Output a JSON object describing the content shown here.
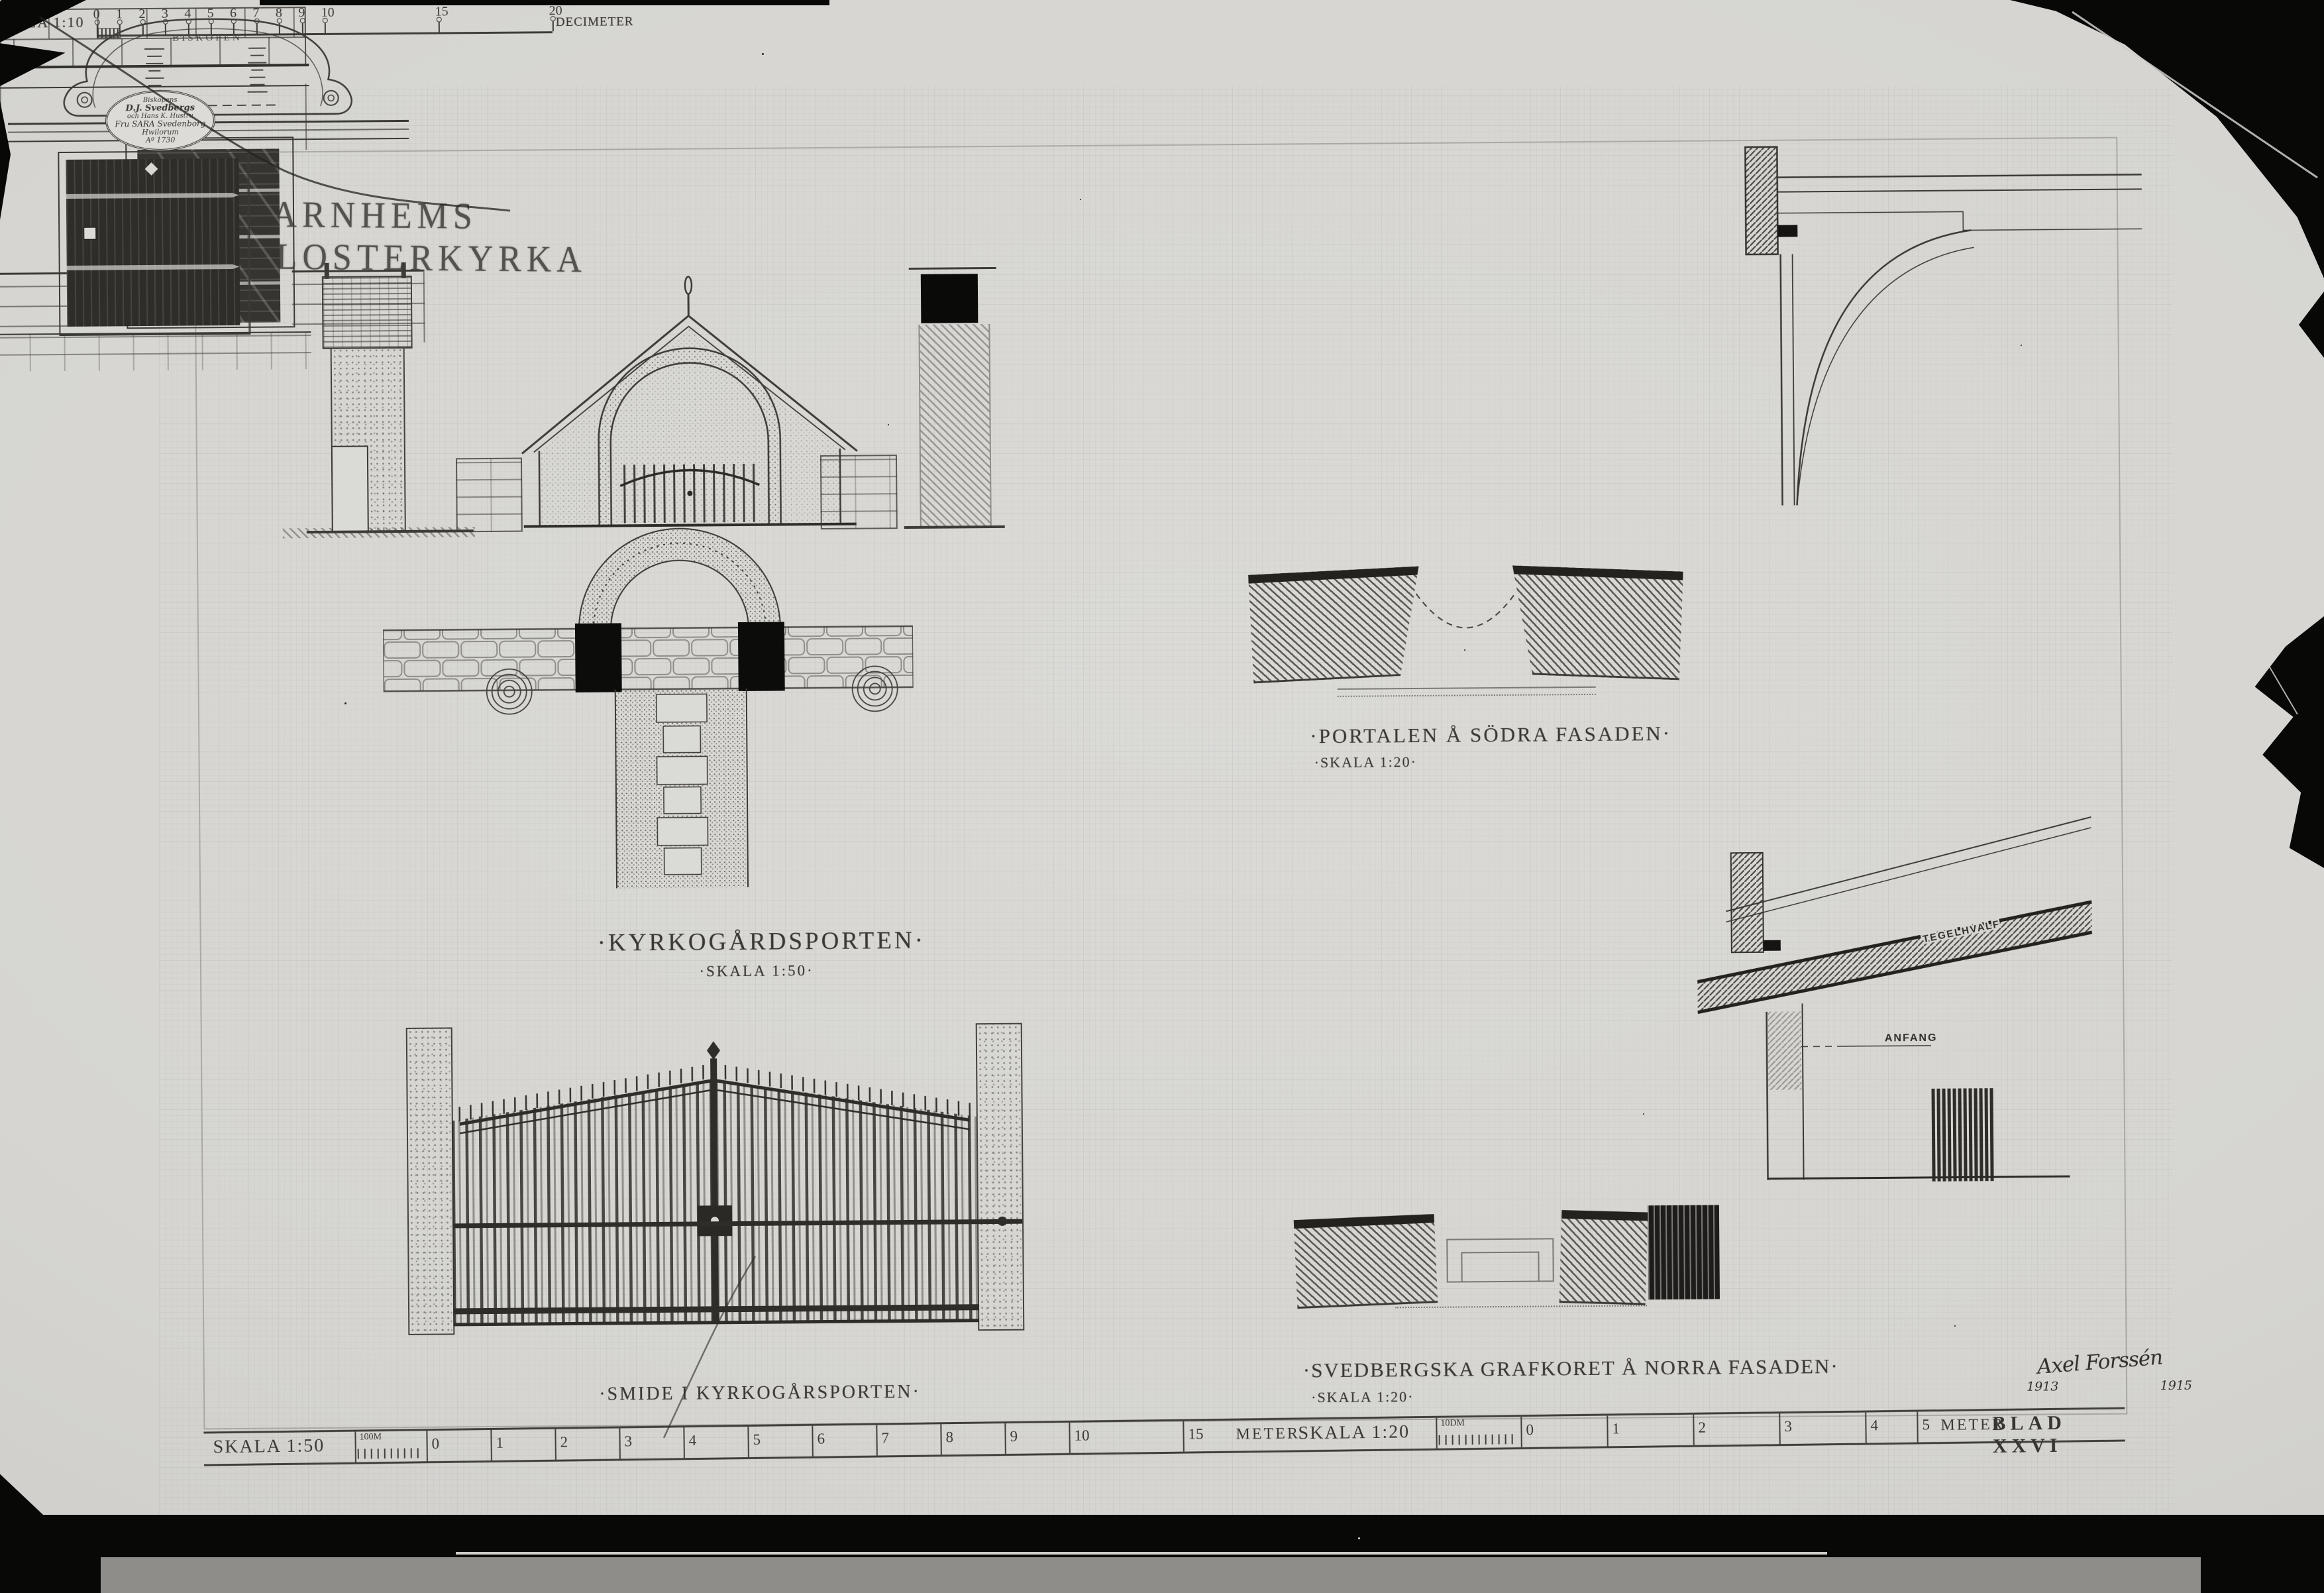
{
  "title": "VARNHEMS KLOSTERKYRKA",
  "kyrkogardsporten": {
    "label": "·KYRKOGÅRDSPORTEN·",
    "scale": "·SKALA 1:50·"
  },
  "smide": {
    "label": "·SMIDE I KYRKOGÅRSPORTEN·",
    "scale_label": "SKALA 1:10",
    "unit": "DECIMETER",
    "ticks": [
      "0",
      "1",
      "2",
      "3",
      "4",
      "5",
      "6",
      "7",
      "8",
      "9",
      "10",
      "15",
      "20"
    ]
  },
  "portalen": {
    "label": "·PORTALEN Å SÖDRA FASADEN·",
    "scale": "·SKALA 1:20·",
    "cartouche_title": "BISKOPEN"
  },
  "grafkoret": {
    "label": "·SVEDBERGSKA GRAFKORET Å NORRA FASADEN·",
    "scale": "·SKALA 1:20·",
    "plaque_lines": [
      "Biskopens",
      "D.J. Svedbergs",
      "och Hans K. Hustru",
      "Fru SARA Svedenborg",
      "Hwilorum",
      "Aº 1730"
    ],
    "section_label_vault": "TEGELHVALF",
    "section_label_anfang": "ANFANG"
  },
  "signature": {
    "name": "Axel Forssén",
    "year_left": "1913",
    "year_right": "1915"
  },
  "footer": {
    "scale50": {
      "label": "SKALA 1:50",
      "subdivision": "100M",
      "ticks": [
        "0",
        "1",
        "2",
        "3",
        "4",
        "5",
        "6",
        "7",
        "8",
        "9",
        "10",
        "15"
      ],
      "unit": "METER"
    },
    "scale20": {
      "label": "SKALA 1:20",
      "subdivision": "10DM",
      "ticks": [
        "0",
        "1",
        "2",
        "3",
        "4",
        "5"
      ],
      "unit": "METER"
    },
    "sheet_number": "BLAD XXVI"
  }
}
